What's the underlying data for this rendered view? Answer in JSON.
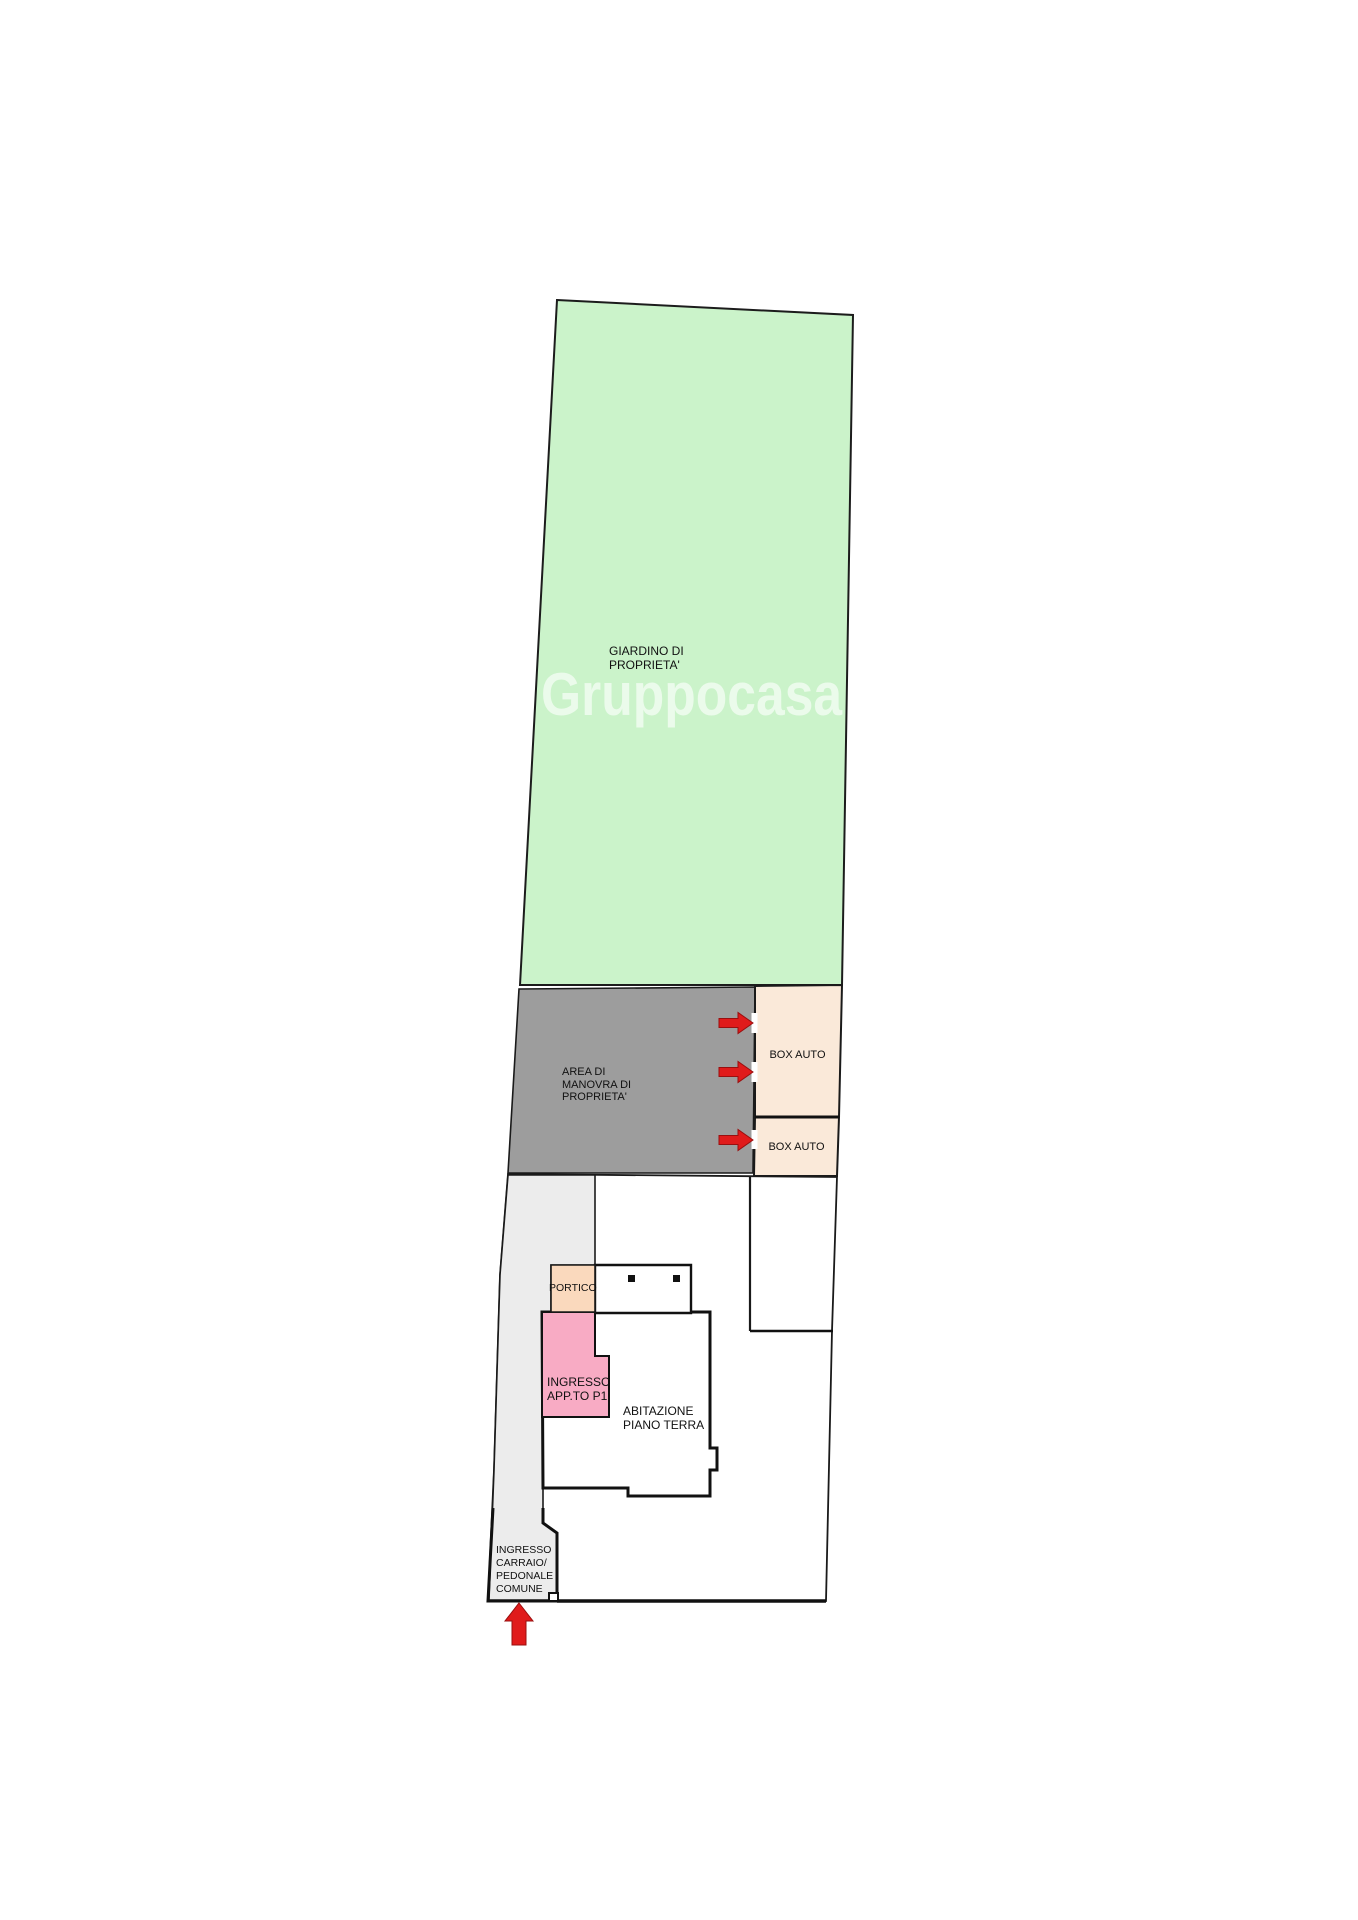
{
  "labels": {
    "garden": "GIARDINO DI\nPROPRIETA'",
    "maneuver_area": "AREA DI\nMANOVRA DI\nPROPRIETA'",
    "box_auto_1": "BOX AUTO",
    "box_auto_2": "BOX AUTO",
    "portico": "PORTICO",
    "apartment_entrance": "INGRESSO\nAPP.TO P1",
    "ground_floor_home": "ABITAZIONE\nPIANO TERRA",
    "common_entrance": "INGRESSO\nCARRAIO/\nPEDONALE\nCOMUNE"
  },
  "watermark": {
    "text": "Gruppocasa"
  },
  "icons": {
    "box_entrance_arrows": "red-right-arrow",
    "street_entrance_arrow": "red-up-arrow"
  },
  "colors": {
    "garden_fill": "#cbf3ca",
    "maneuver_fill": "#9d9d9d",
    "garage_fill": "#fae9d9",
    "portico_fill": "#fad9bd",
    "apartment_entrance_fill": "#f8abc4",
    "driveway_fill": "#ececec",
    "house_fill": "#ffffff",
    "arrow_red": "#e01b1b",
    "outline": "#1a1a1a"
  }
}
